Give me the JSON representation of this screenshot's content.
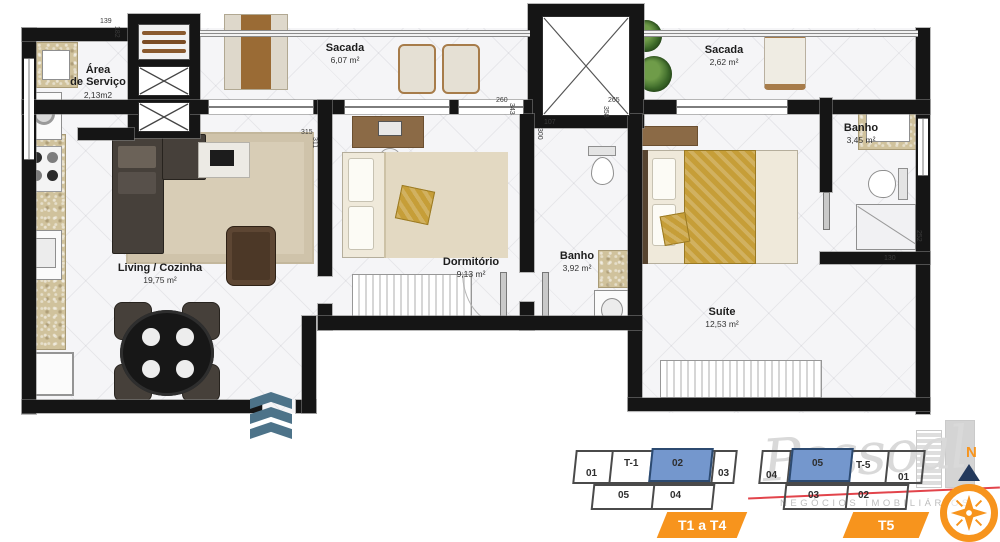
{
  "floorplan": {
    "rooms": {
      "servico": {
        "line1": "Área",
        "line2": "de Serviço",
        "area": "2,13m2"
      },
      "sacada1": {
        "name": "Sacada",
        "area": "6,07 m²"
      },
      "sacada2": {
        "name": "Sacada",
        "area": "2,62 m²"
      },
      "banho_suite": {
        "name": "Banho",
        "area": "3,45 m²"
      },
      "dormitorio": {
        "name": "Dormitório",
        "area": "9,13 m²"
      },
      "banho_social": {
        "name": "Banho",
        "area": "3,92 m²"
      },
      "living": {
        "name": "Living / Cozinha",
        "area": "19,75 m²"
      },
      "suite": {
        "name": "Suíte",
        "area": "12,53 m²"
      }
    },
    "dimensions": {
      "d139": "139",
      "d182": "182",
      "d315": "315",
      "d311": "311",
      "d260": "260",
      "d343": "343",
      "d107": "107",
      "d300": "300",
      "d265": "265",
      "d358": "358",
      "d130": "130",
      "d252": "252"
    }
  },
  "legend": {
    "t1": {
      "tag": "T1 a T4",
      "highlighted_unit": "02",
      "units": {
        "u01": "01",
        "t": "T-1",
        "u02": "02",
        "u03": "03",
        "u05": "05",
        "u04": "04"
      }
    },
    "t5": {
      "tag": "T5",
      "highlighted_unit": "05",
      "units": {
        "u04": "04",
        "u05": "05",
        "t": "T-5",
        "u01": "01",
        "u03": "03",
        "u02": "02"
      }
    }
  },
  "branding": {
    "script": "Pessoal",
    "subtitle": "NEGÓCIOS IMOBILIÁRIOS"
  },
  "compass": {
    "north": "N"
  },
  "colors": {
    "accent_orange": "#f7941d",
    "unit_highlight_blue": "#7497cd",
    "entry_arrow_blue": "#4d7389",
    "logo_red": "#e2444b",
    "wall_black": "#151515"
  }
}
